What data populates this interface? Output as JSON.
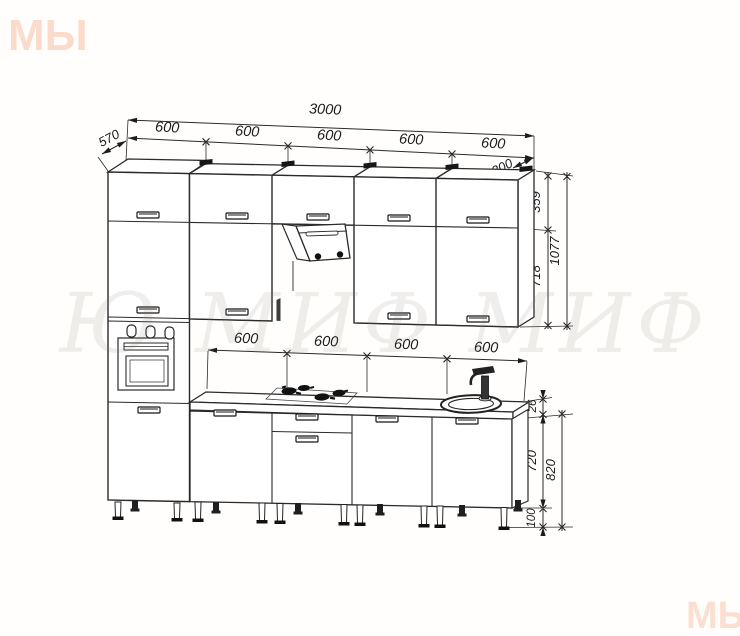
{
  "drawing": {
    "type": "kitchen cabinet set elevation drawing",
    "colors": {
      "line": "#2a2a2a",
      "background": "#fffefd",
      "watermark_logo": "#f29a6a",
      "watermark_text": "#8a7f6e"
    }
  },
  "watermarks": {
    "logo_top_left": "МЫ",
    "logo_bottom_right": "МЫ",
    "center_text": "Ю МИФ МИФ"
  },
  "dims": {
    "total_width": "3000",
    "tall_cabinet_depth": "570",
    "wall_cabinet_depth": "300",
    "top_segments": [
      "600",
      "600",
      "600",
      "600",
      "600"
    ],
    "upper_door_height": "359",
    "lower_door_height": "718",
    "wall_cabinet_total_height": "1077",
    "base_segments": [
      "600",
      "600",
      "600",
      "600"
    ],
    "countertop_thickness": "26",
    "base_cabinet_height": "720",
    "base_total_height": "820",
    "leg_height": "100"
  }
}
